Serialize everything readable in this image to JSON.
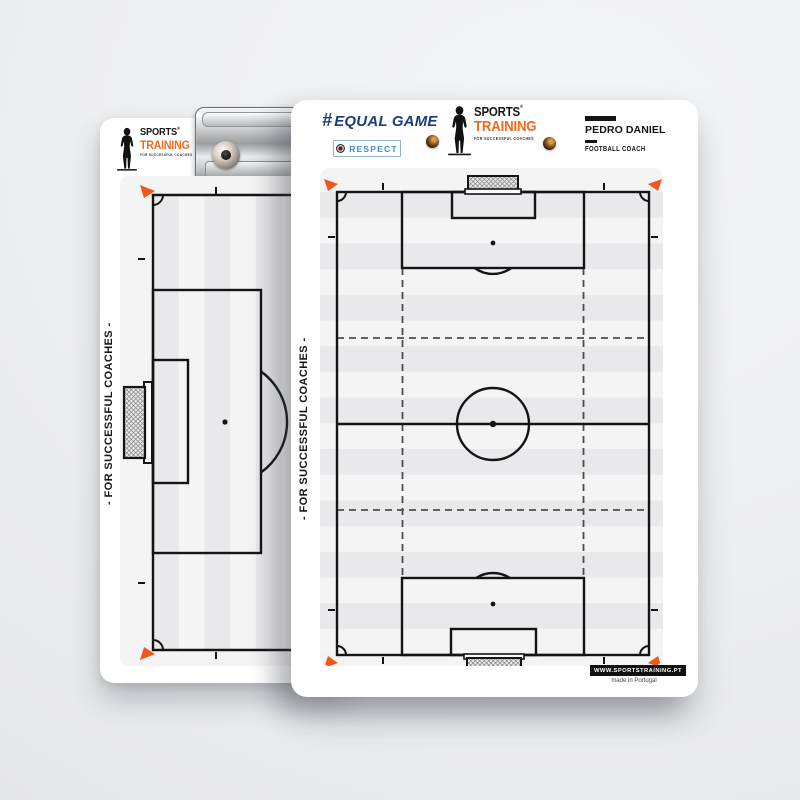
{
  "scene": {
    "background": "#eceef0"
  },
  "brand": {
    "name_top": "SPORTS",
    "name_bottom": "TRAINING",
    "registered": "®",
    "tagline": "FOR SUCCESSFUL COACHES"
  },
  "left_board": {
    "side_text": "- FOR SUCCESSFUL COACHES -"
  },
  "right_board": {
    "equal_game_hash": "#",
    "equal_game_text": "EQUAL GAME",
    "respect_text": "RESPECT",
    "coach_name": "PEDRO DANIEL",
    "coach_title": "FOOTBALL COACH",
    "side_text": "- FOR SUCCESSFUL COACHES -",
    "website": "WWW.SPORTSTRAINING.PT",
    "origin": "made in Portugal"
  },
  "colors": {
    "equal_game_navy": "#1e3c78",
    "respect_blue": "#3d8fc9",
    "brand_orange": "#ee6a1c",
    "pitch_line": "#141414",
    "corner_flag_orange": "#f2561c",
    "stripe_gray": "#e9e9eb"
  }
}
